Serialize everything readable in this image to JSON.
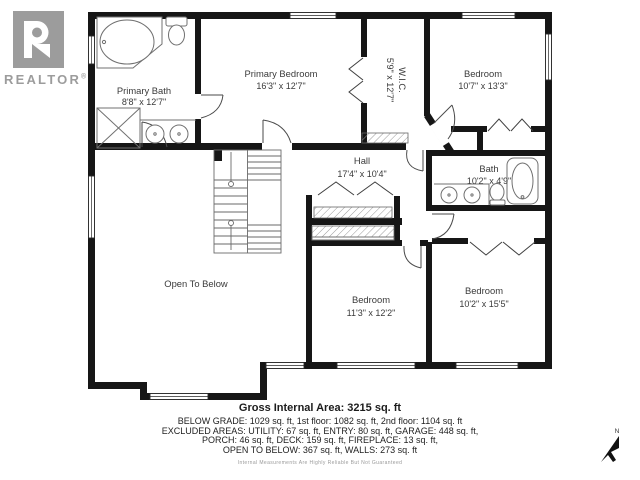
{
  "logo": {
    "letter": "R",
    "brand": "REALTOR",
    "registered": "®"
  },
  "compass": {
    "label": "N"
  },
  "rooms": [
    {
      "id": "primary-bath",
      "name": "Primary Bath",
      "dims": "8'8\" x 12'7\""
    },
    {
      "id": "primary-bedroom",
      "name": "Primary Bedroom",
      "dims": "16'3\" x 12'7\""
    },
    {
      "id": "wic",
      "name": "W.I.C.",
      "dims": "5'9\" x 12'7\""
    },
    {
      "id": "bedroom-top-right",
      "name": "Bedroom",
      "dims": "10'7\" x 13'3\""
    },
    {
      "id": "hall",
      "name": "Hall",
      "dims": "17'4\" x 10'4\""
    },
    {
      "id": "bath",
      "name": "Bath",
      "dims": "10'2\" x 4'9\""
    },
    {
      "id": "open-to-below",
      "name": "Open To Below",
      "dims": ""
    },
    {
      "id": "bedroom-bottom-middle",
      "name": "Bedroom",
      "dims": "11'3\" x 12'2\""
    },
    {
      "id": "bedroom-bottom-right",
      "name": "Bedroom",
      "dims": "10'2\" x 15'5\""
    }
  ],
  "footer": {
    "gross": "Gross Internal Area: 3215 sq. ft",
    "line1": "BELOW GRADE: 1029 sq. ft, 1st floor: 1082 sq. ft, 2nd floor: 1104 sq. ft",
    "line2": "EXCLUDED AREAS: UTILITY: 67 sq. ft, ENTRY: 80 sq. ft, GARAGE: 448 sq. ft,",
    "line3": "PORCH: 46 sq. ft, DECK: 159 sq. ft, FIREPLACE: 13 sq. ft,",
    "line4": "OPEN TO BELOW: 367 sq. ft, WALLS: 273 sq. ft",
    "disclaimer": "Internal Measurements Are Highly Reliable But Not Guaranteed"
  },
  "colors": {
    "wall": "#161616",
    "fixture": "#707070",
    "label": "#3a3a3a",
    "logo_gray": "#9c9c9c"
  }
}
